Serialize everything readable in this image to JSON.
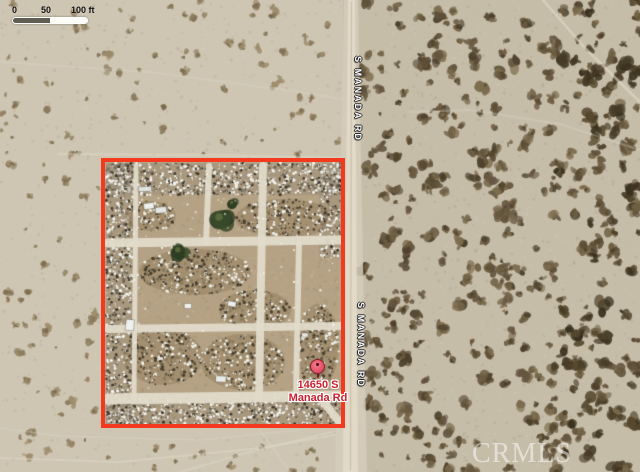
{
  "map": {
    "scale_bar": {
      "ticks": [
        "0",
        "50",
        "100 ft"
      ]
    },
    "road_labels": [
      "S MANADA RD",
      "S MANADA RD"
    ],
    "marker": {
      "line1": "14650 S",
      "line2": "Manada Rd"
    },
    "watermark": "CRMLS",
    "colors": {
      "boundary": "#f43a1e",
      "marker_text": "#c9202e",
      "pin_fill": "#e4566a",
      "pin_border": "#8e1f2b",
      "terrain_base": "#c6bda9",
      "terrain_dirt": "#b5a284",
      "road": "#e2dac7"
    }
  }
}
